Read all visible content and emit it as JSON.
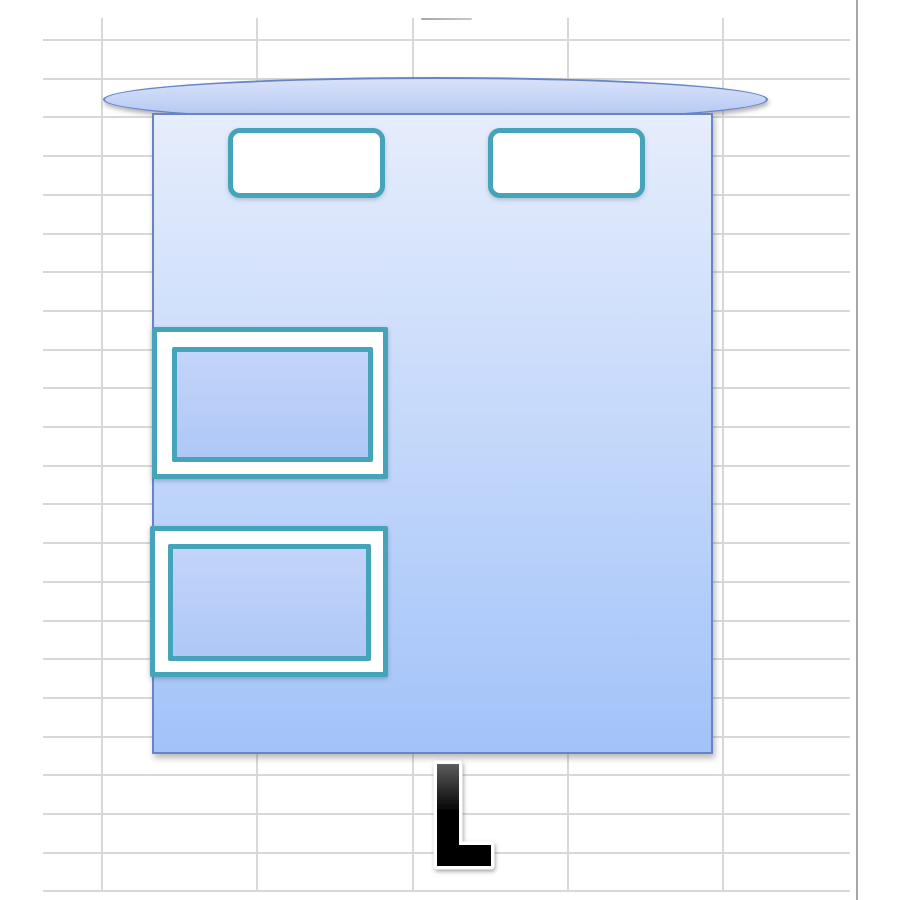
{
  "canvas": {
    "width": 900,
    "height": 900,
    "background": "#ffffff"
  },
  "colors": {
    "grid_line": "#d8d8d8",
    "grid_edge": "#a6a6a6",
    "teal_border": "#45a3ba",
    "shape_border_blue": "#6784c7",
    "ellipse_fill_top": "#d8e2f9",
    "ellipse_fill_bottom": "#b2c6f3",
    "body_fill_top": "#e6edfc",
    "body_fill_bottom": "#a2c3f9",
    "window_fill_top": "#c3d4f9",
    "window_fill_bottom": "#afc8f7",
    "slot_fill": "#ffffff",
    "letter_top": "#5c5c5c",
    "letter_bottom": "#000000",
    "letter_outline": "#ffffff"
  },
  "spreadsheet_grid": {
    "h_lines": {
      "x": 43,
      "width": 807,
      "y_start": 40,
      "step": 38.7,
      "count": 23
    },
    "v_lines": {
      "xs": [
        102,
        257,
        413,
        568,
        723
      ],
      "y": 18,
      "height": 873
    },
    "right_edge": {
      "x": 856,
      "height": 900
    },
    "top_tick": {
      "x": 421,
      "y": 18,
      "width": 51
    }
  },
  "shapes": {
    "canopy_ellipse": {
      "type": "ellipse",
      "fill": "blue-gradient",
      "border": "blue"
    },
    "body_rect": {
      "type": "rectangle",
      "fill": "blue-gradient",
      "border": "blue"
    },
    "top_slot_left": {
      "type": "rounded-rectangle",
      "fill": "white",
      "border": "teal"
    },
    "top_slot_right": {
      "type": "rounded-rectangle",
      "fill": "white",
      "border": "teal"
    },
    "window_upper": {
      "type": "double-framed-rectangle",
      "fill": "blue-gradient",
      "border": "teal"
    },
    "window_lower": {
      "type": "double-framed-rectangle",
      "fill": "blue-gradient",
      "border": "teal"
    },
    "letter_l": {
      "type": "letter",
      "glyph": "L"
    }
  }
}
